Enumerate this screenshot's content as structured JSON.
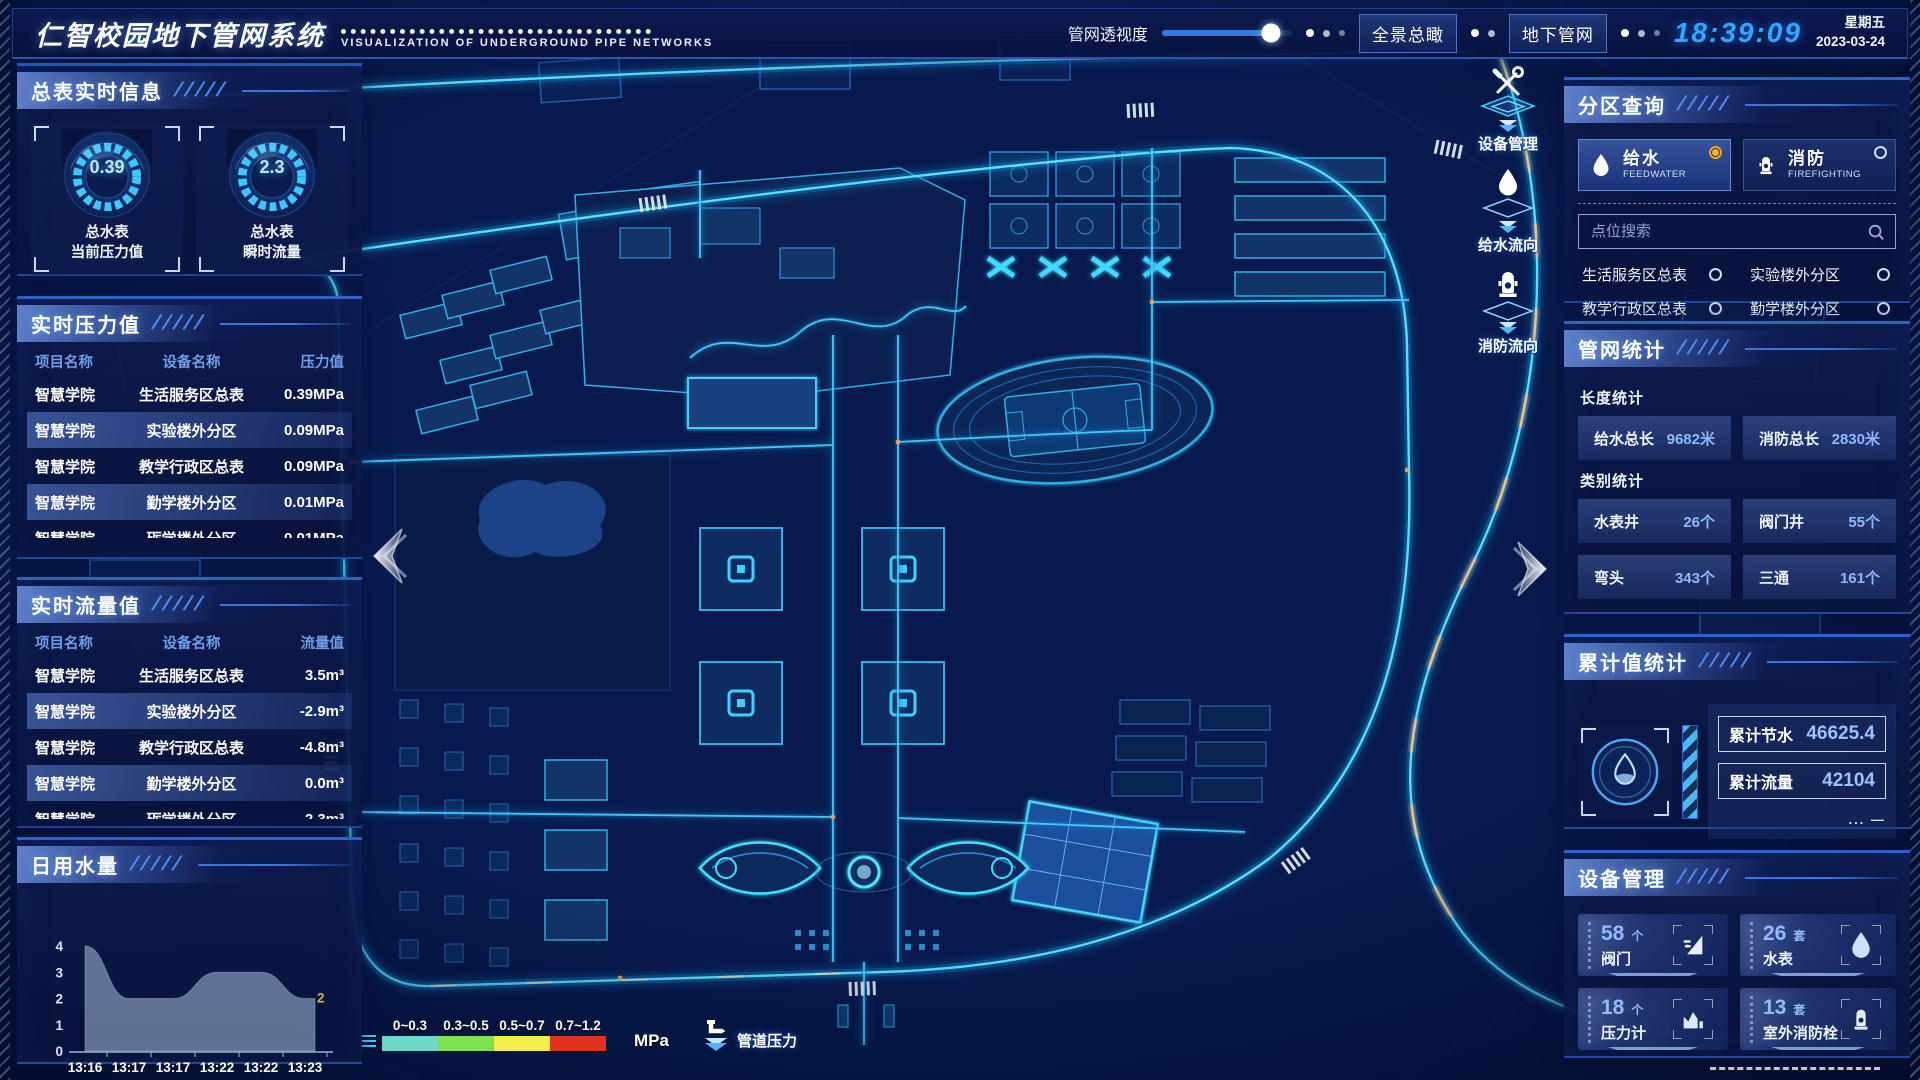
{
  "header": {
    "title": "仁智校园地下管网系统",
    "subtitle": "VISUALIZATION OF UNDERGROUND PIPE NETWORKS",
    "transparency_label": "管网透视度",
    "overview_button": "全景总瞰",
    "underground_button": "地下管网",
    "clock": "18:39:09",
    "weekday": "星期五",
    "date": "2023-03-24"
  },
  "left_sidebar": {
    "master_info": {
      "title": "总表实时信息",
      "gauges": [
        {
          "value": "0.39",
          "line1": "总水表",
          "line2": "当前压力值"
        },
        {
          "value": "2.3",
          "line1": "总水表",
          "line2": "瞬时流量"
        }
      ]
    },
    "pressure": {
      "title": "实时压力值",
      "columns": [
        "项目名称",
        "设备名称",
        "压力值"
      ],
      "rows": [
        [
          "智慧学院",
          "生活服务区总表",
          "0.39MPa"
        ],
        [
          "智慧学院",
          "实验楼外分区",
          "0.09MPa"
        ],
        [
          "智慧学院",
          "教学行政区总表",
          "0.09MPa"
        ],
        [
          "智慧学院",
          "勤学楼外分区",
          "0.01MPa"
        ],
        [
          "智慧学院",
          "砺学楼外分区",
          "0.01MPa"
        ]
      ]
    },
    "flow": {
      "title": "实时流量值",
      "columns": [
        "项目名称",
        "设备名称",
        "流量值"
      ],
      "rows": [
        [
          "智慧学院",
          "生活服务区总表",
          "3.5m³"
        ],
        [
          "智慧学院",
          "实验楼外分区",
          "-2.9m³"
        ],
        [
          "智慧学院",
          "教学行政区总表",
          "-4.8m³"
        ],
        [
          "智慧学院",
          "勤学楼外分区",
          "0.0m³"
        ],
        [
          "智慧学院",
          "砺学楼外分区",
          "2.3m³"
        ]
      ]
    },
    "daily_water": {
      "title": "日用水量",
      "chart_data": {
        "type": "area",
        "categories": [
          "13:16",
          "13:17",
          "13:17",
          "13:22",
          "13:22",
          "13:23"
        ],
        "values": [
          4,
          2,
          2,
          3,
          3,
          2
        ],
        "ylim": [
          0,
          4
        ],
        "yticks": [
          0,
          1,
          2,
          3,
          4
        ],
        "end_label": "2",
        "area_color": "#a8c0dc",
        "end_label_color": "#d7b43c"
      }
    }
  },
  "map": {
    "toolbar": [
      {
        "icon": "wrench-icon",
        "label": "设备管理"
      },
      {
        "icon": "water-drop-icon",
        "label": "给水流向"
      },
      {
        "icon": "hydrant-icon",
        "label": "消防流向"
      }
    ],
    "legend": {
      "segments": [
        {
          "range": "0~0.3",
          "color": "#6fd8c8"
        },
        {
          "range": "0.3~0.5",
          "color": "#7ee14f"
        },
        {
          "range": "0.5~0.7",
          "color": "#f2ed4a"
        },
        {
          "range": "0.7~1.2",
          "color": "#e0301e"
        }
      ],
      "unit": "MPa",
      "label": "管道压力"
    }
  },
  "right_sidebar": {
    "zone_query": {
      "title": "分区查询",
      "tabs": [
        {
          "label": "给水",
          "sub": "FEEDWATER",
          "selected": true
        },
        {
          "label": "消防",
          "sub": "FIREFIGHTING",
          "selected": false
        }
      ],
      "search_placeholder": "点位搜索",
      "options": [
        "生活服务区总表",
        "实验楼外分区",
        "教学行政区总表",
        "勤学楼外分区",
        "砺学楼外分区",
        "宿舍区泵房"
      ]
    },
    "pipe_stats": {
      "title": "管网统计",
      "length_label": "长度统计",
      "length_items": [
        {
          "label": "给水总长",
          "value": "9682米"
        },
        {
          "label": "消防总长",
          "value": "2830米"
        }
      ],
      "category_label": "类别统计",
      "category_items": [
        {
          "label": "水表井",
          "value": "26个"
        },
        {
          "label": "阀门井",
          "value": "55个"
        },
        {
          "label": "弯头",
          "value": "343个"
        },
        {
          "label": "三通",
          "value": "161个"
        }
      ]
    },
    "cumulative": {
      "title": "累计值统计",
      "items": [
        {
          "label": "累计节水",
          "value": "46625.4"
        },
        {
          "label": "累计流量",
          "value": "42104"
        }
      ]
    },
    "devices": {
      "title": "设备管理",
      "cards": [
        {
          "count": "58",
          "unit": "个",
          "label": "阀门",
          "icon": "valve-icon"
        },
        {
          "count": "26",
          "unit": "套",
          "label": "水表",
          "icon": "water-meter-icon"
        },
        {
          "count": "18",
          "unit": "个",
          "label": "压力计",
          "icon": "pressure-gauge-icon"
        },
        {
          "count": "13",
          "unit": "套",
          "label": "室外消防栓",
          "icon": "hydrant-icon"
        }
      ]
    }
  }
}
